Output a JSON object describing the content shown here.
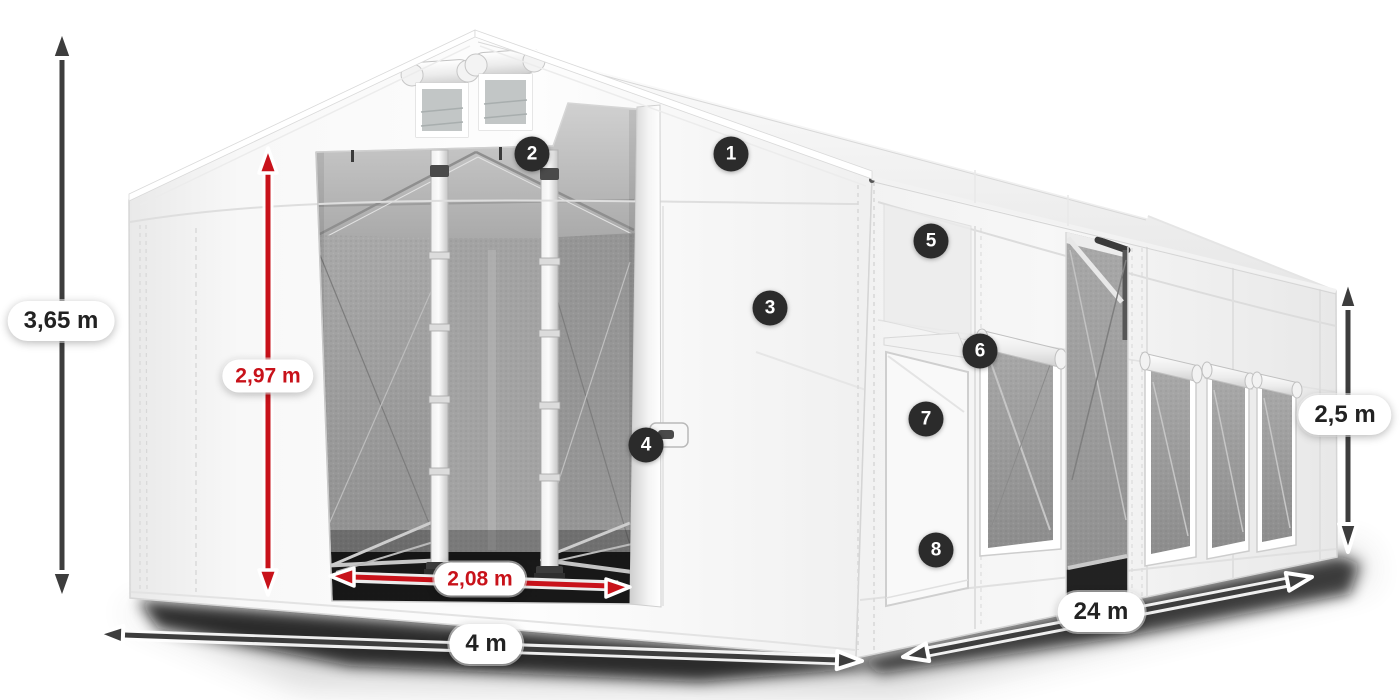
{
  "diagram": {
    "subject": "storage-tent-dimension-diagram",
    "dimensions": {
      "total_height": {
        "label": "3,65 m",
        "style": "dark"
      },
      "clear_height": {
        "label": "2,97 m",
        "style": "red"
      },
      "door_width": {
        "label": "2,08 m",
        "style": "red"
      },
      "width": {
        "label": "4 m",
        "style": "dark"
      },
      "length": {
        "label": "24 m",
        "style": "dark"
      },
      "side_height": {
        "label": "2,5 m",
        "style": "dark"
      }
    },
    "callouts": [
      {
        "number": "1"
      },
      {
        "number": "2"
      },
      {
        "number": "3"
      },
      {
        "number": "4"
      },
      {
        "number": "5"
      },
      {
        "number": "6"
      },
      {
        "number": "7"
      },
      {
        "number": "8"
      }
    ],
    "colors": {
      "arrow_dark": "#3d3d3d",
      "arrow_red": "#c8121a",
      "badge_bg": "#2b2b2b",
      "badge_text": "#ffffff",
      "label_text": "#222222"
    }
  }
}
